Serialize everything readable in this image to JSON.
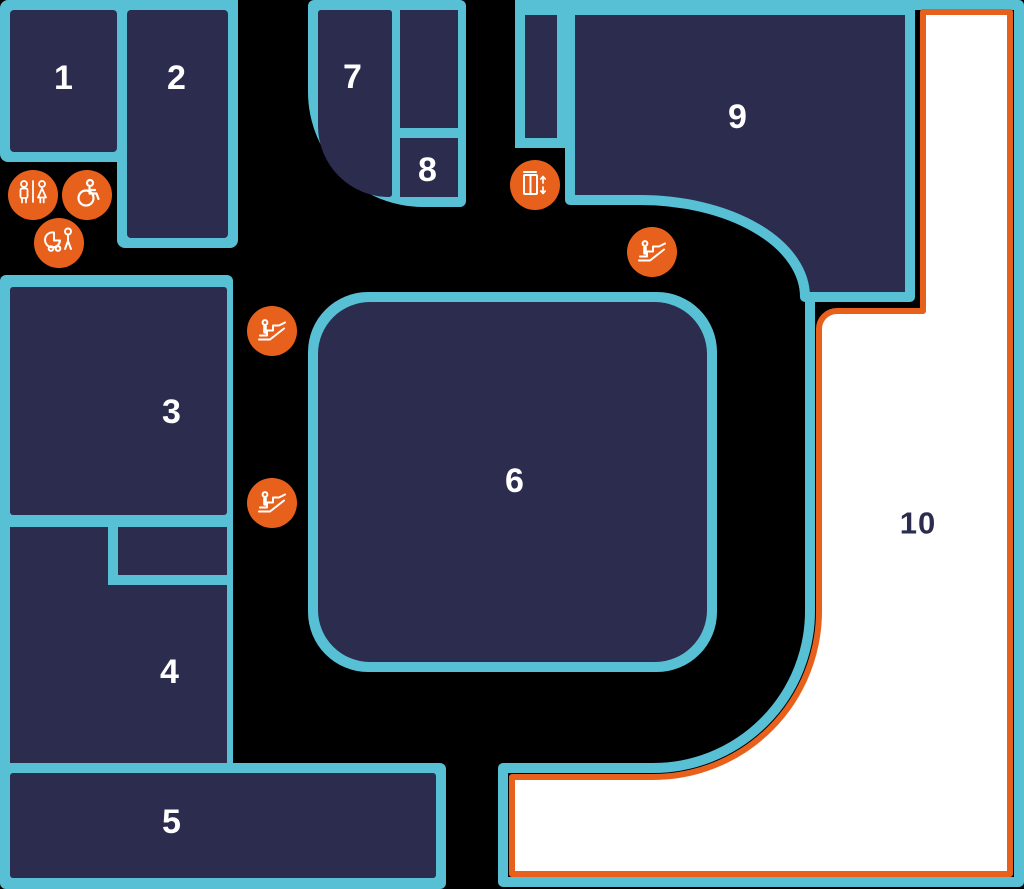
{
  "map": {
    "title": "floor-plan",
    "rooms": [
      {
        "number": "1"
      },
      {
        "number": "2"
      },
      {
        "number": "3"
      },
      {
        "number": "4"
      },
      {
        "number": "5"
      },
      {
        "number": "6"
      },
      {
        "number": "7"
      },
      {
        "number": "8"
      },
      {
        "number": "9"
      },
      {
        "number": "10"
      }
    ],
    "facilities": {
      "toilets_icon": "male-female-toilets",
      "accessible_icon": "wheelchair-accessible-toilet",
      "baby_icon": "baby-change-family",
      "lift_icon": "elevator-up-down",
      "escalator_icon": "escalator-person"
    },
    "colors": {
      "outline_teal": "#57c0d5",
      "room_fill_navy": "#2b2c4e",
      "icon_orange": "#e8611c",
      "highlight_white": "#ffffff",
      "background": "#000000"
    }
  }
}
